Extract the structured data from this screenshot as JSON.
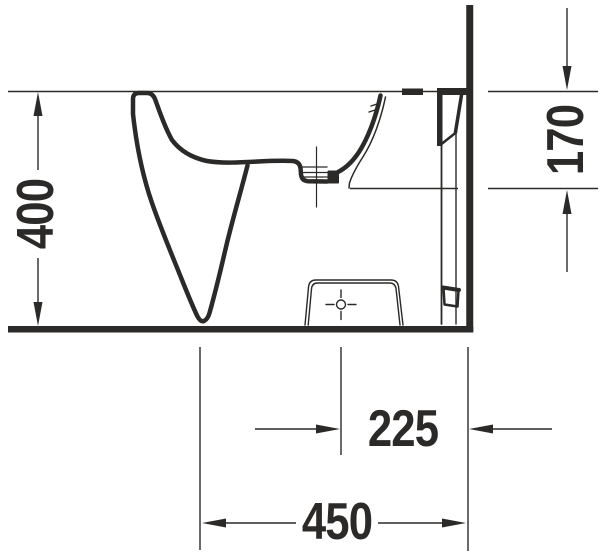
{
  "diagram": {
    "line_color": "#2b2a28",
    "background_color": "#ffffff",
    "dimensions": [
      {
        "id": "overall-height",
        "value": "400",
        "orientation": "vertical",
        "side": "left"
      },
      {
        "id": "rim-to-outlet-height",
        "value": "170",
        "orientation": "vertical",
        "side": "right"
      },
      {
        "id": "outlet-center-to-wall",
        "value": "225",
        "orientation": "horizontal",
        "side": "bottom"
      },
      {
        "id": "overall-depth",
        "value": "450",
        "orientation": "horizontal",
        "side": "bottom"
      }
    ]
  }
}
